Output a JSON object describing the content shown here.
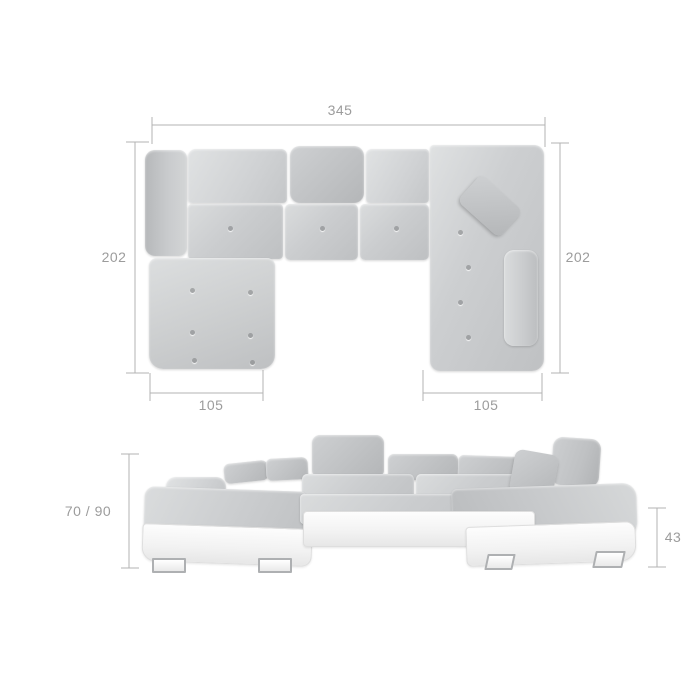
{
  "dimensions": {
    "top_view": {
      "total_width": "345",
      "left_depth": "202",
      "right_depth": "202",
      "left_chaise_width": "105",
      "right_chaise_width": "105"
    },
    "front_view": {
      "backrest_height": "70 / 90",
      "seat_height": "43"
    }
  },
  "colors": {
    "fabric": "#c8cacc",
    "fabric_shadow": "#b6b8ba",
    "base_white": "#f4f4f4",
    "dimension_lines": "#b3b3b3",
    "dimension_text": "#9c9c9c",
    "background": "#ffffff"
  }
}
